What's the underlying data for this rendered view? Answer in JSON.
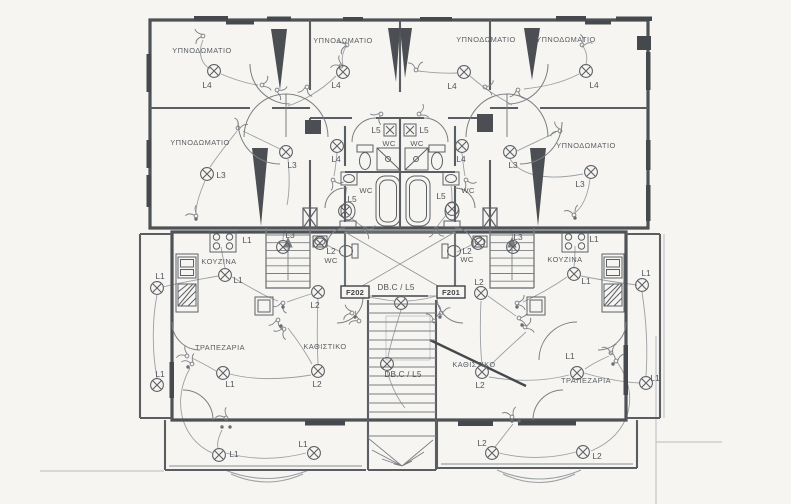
{
  "drawing": {
    "type": "electrical-floor-plan",
    "language": "Greek",
    "colors": {
      "paper": "#f6f5f1",
      "wall": "#4e5256",
      "ink": "#6a6e72",
      "wire": "#9aa0a4",
      "dark_fill": "#45494d",
      "text": "#5a5e63"
    },
    "rooms": [
      {
        "text": "ΥΠΝΟΔΩΜΑΤΙΟ",
        "x": 202,
        "y": 53
      },
      {
        "text": "ΥΠΝΟΔΩΜΑΤΙΟ",
        "x": 343,
        "y": 43
      },
      {
        "text": "ΥΠΝΟΔΩΜΑΤΙΟ",
        "x": 486,
        "y": 42
      },
      {
        "text": "ΥΠΝΟΔΩΜΑΤΙΟ",
        "x": 566,
        "y": 42
      },
      {
        "text": "ΥΠΝΟΔΩΜΑΤΙΟ",
        "x": 200,
        "y": 145
      },
      {
        "text": "ΥΠΝΟΔΩΜΑΤΙΟ",
        "x": 586,
        "y": 148
      },
      {
        "text": "ΚΟΥΖΙΝΑ",
        "x": 219,
        "y": 264
      },
      {
        "text": "ΚΟΥΖΙΝΑ",
        "x": 565,
        "y": 262
      },
      {
        "text": "ΤΡΑΠΕΖΑΡΙΑ",
        "x": 220,
        "y": 350
      },
      {
        "text": "ΤΡΑΠΕΖΑΡΙΑ",
        "x": 586,
        "y": 383
      },
      {
        "text": "ΚΑΘΙΣΤΙΚΟ",
        "x": 325,
        "y": 349
      },
      {
        "text": "ΚΑΘΙΣΤΙΚΟ",
        "x": 474,
        "y": 367
      }
    ],
    "wc_labels": [
      {
        "text": "WC",
        "x": 389,
        "y": 146
      },
      {
        "text": "WC",
        "x": 417,
        "y": 146
      },
      {
        "text": "WC",
        "x": 366,
        "y": 193
      },
      {
        "text": "WC",
        "x": 468,
        "y": 193
      },
      {
        "text": "WC",
        "x": 331,
        "y": 263
      },
      {
        "text": "WC",
        "x": 467,
        "y": 262
      }
    ],
    "panels": [
      {
        "text": "F202",
        "x": 355,
        "y": 295,
        "bx": 341,
        "by": 286,
        "w": 28,
        "h": 12
      },
      {
        "text": "F201",
        "x": 451,
        "y": 295,
        "bx": 437,
        "by": 286,
        "w": 28,
        "h": 12
      }
    ],
    "db_labels": [
      {
        "text": "DB.C / L5",
        "x": 396,
        "y": 290
      },
      {
        "text": "DB.C / L5",
        "x": 403,
        "y": 377
      }
    ],
    "lamps": [
      {
        "x": 214,
        "y": 71,
        "label": "L4",
        "lx": 207,
        "ly": 88
      },
      {
        "x": 343,
        "y": 72,
        "label": "L4",
        "lx": 336,
        "ly": 88
      },
      {
        "x": 464,
        "y": 72,
        "label": "L4",
        "lx": 452,
        "ly": 89
      },
      {
        "x": 586,
        "y": 71,
        "label": "L4",
        "lx": 594,
        "ly": 88
      },
      {
        "x": 207,
        "y": 174,
        "label": "L3",
        "lx": 221,
        "ly": 178
      },
      {
        "x": 286,
        "y": 152,
        "label": "L3",
        "lx": 292,
        "ly": 168
      },
      {
        "x": 510,
        "y": 152,
        "label": "L3",
        "lx": 513,
        "ly": 168
      },
      {
        "x": 591,
        "y": 172,
        "label": "L3",
        "lx": 580,
        "ly": 187
      },
      {
        "x": 337,
        "y": 146,
        "label": "L4",
        "lx": 336,
        "ly": 162
      },
      {
        "x": 462,
        "y": 146,
        "label": "L4",
        "lx": 461,
        "ly": 162
      },
      {
        "x": 345,
        "y": 211,
        "label": "L5",
        "lx": 352,
        "ly": 202
      },
      {
        "x": 452,
        "y": 209,
        "label": "L5",
        "lx": 441,
        "ly": 199
      },
      {
        "x": 320,
        "y": 243,
        "label": "L2",
        "lx": 331,
        "ly": 254
      },
      {
        "x": 478,
        "y": 243,
        "label": "L2",
        "lx": 467,
        "ly": 254
      },
      {
        "x": 283,
        "y": 247,
        "label": "L3",
        "lx": 290,
        "ly": 238
      },
      {
        "x": 513,
        "y": 247,
        "label": "L3",
        "lx": 518,
        "ly": 240
      },
      {
        "x": 401,
        "y": 303,
        "label": "",
        "lx": 0,
        "ly": 0
      },
      {
        "x": 387,
        "y": 364,
        "label": "",
        "lx": 0,
        "ly": 0
      },
      {
        "x": 225,
        "y": 275,
        "label": "L1",
        "lx": 238,
        "ly": 283
      },
      {
        "x": 574,
        "y": 274,
        "label": "L1",
        "lx": 586,
        "ly": 284
      },
      {
        "x": 157,
        "y": 288,
        "label": "L1",
        "lx": 160,
        "ly": 279
      },
      {
        "x": 157,
        "y": 385,
        "label": "L1",
        "lx": 160,
        "ly": 377
      },
      {
        "x": 642,
        "y": 285,
        "label": "L1",
        "lx": 646,
        "ly": 276
      },
      {
        "x": 646,
        "y": 383,
        "label": "L1",
        "lx": 655,
        "ly": 381
      },
      {
        "x": 223,
        "y": 373,
        "label": "L1",
        "lx": 230,
        "ly": 387
      },
      {
        "x": 318,
        "y": 292,
        "label": "L2",
        "lx": 315,
        "ly": 308
      },
      {
        "x": 318,
        "y": 371,
        "label": "L2",
        "lx": 317,
        "ly": 387
      },
      {
        "x": 481,
        "y": 293,
        "label": "L2",
        "lx": 479,
        "ly": 285
      },
      {
        "x": 482,
        "y": 372,
        "label": "L2",
        "lx": 480,
        "ly": 388
      },
      {
        "x": 577,
        "y": 373,
        "label": "L1",
        "lx": 570,
        "ly": 359
      },
      {
        "x": 219,
        "y": 455,
        "label": "L1",
        "lx": 234,
        "ly": 457
      },
      {
        "x": 314,
        "y": 453,
        "label": "L1",
        "lx": 303,
        "ly": 447
      },
      {
        "x": 492,
        "y": 453,
        "label": "L2",
        "lx": 482,
        "ly": 446
      },
      {
        "x": 583,
        "y": 452,
        "label": "L2",
        "lx": 597,
        "ly": 459
      }
    ],
    "sconces": [
      {
        "x": 390,
        "y": 130,
        "label": "L5",
        "lx": 376,
        "ly": 133
      },
      {
        "x": 410,
        "y": 130,
        "label": "L5",
        "lx": 424,
        "ly": 133
      }
    ],
    "extra_labels": [
      {
        "text": "L1",
        "x": 247,
        "y": 243
      },
      {
        "text": "L1",
        "x": 594,
        "y": 242
      }
    ],
    "switches": [
      {
        "x": 203,
        "y": 36,
        "r": 210
      },
      {
        "x": 262,
        "y": 85,
        "r": 20
      },
      {
        "x": 277,
        "y": 90,
        "r": 60
      },
      {
        "x": 307,
        "y": 87,
        "r": 140
      },
      {
        "x": 341,
        "y": 66,
        "r": 250
      },
      {
        "x": 347,
        "y": 45,
        "r": 200
      },
      {
        "x": 416,
        "y": 70,
        "r": 300
      },
      {
        "x": 582,
        "y": 45,
        "r": 340
      },
      {
        "x": 485,
        "y": 87,
        "r": 40
      },
      {
        "x": 518,
        "y": 90,
        "r": 130
      },
      {
        "x": 238,
        "y": 128,
        "r": 330
      },
      {
        "x": 560,
        "y": 131,
        "r": 230
      },
      {
        "x": 381,
        "y": 114,
        "r": 170
      },
      {
        "x": 419,
        "y": 114,
        "r": 10
      },
      {
        "x": 333,
        "y": 180,
        "r": 90
      },
      {
        "x": 466,
        "y": 180,
        "r": 90
      },
      {
        "x": 365,
        "y": 229,
        "r": 60
      },
      {
        "x": 436,
        "y": 229,
        "r": 120
      },
      {
        "x": 196,
        "y": 216,
        "r": 260
      },
      {
        "x": 574,
        "y": 215,
        "r": 280
      },
      {
        "x": 352,
        "y": 313,
        "r": 220
      },
      {
        "x": 359,
        "y": 321,
        "r": 240
      },
      {
        "x": 441,
        "y": 313,
        "r": 320
      },
      {
        "x": 434,
        "y": 321,
        "r": 300
      },
      {
        "x": 283,
        "y": 303,
        "r": 150
      },
      {
        "x": 517,
        "y": 303,
        "r": 30
      },
      {
        "x": 278,
        "y": 320,
        "r": 140
      },
      {
        "x": 284,
        "y": 329,
        "r": 160
      },
      {
        "x": 519,
        "y": 318,
        "r": 40
      },
      {
        "x": 525,
        "y": 327,
        "r": 20
      },
      {
        "x": 187,
        "y": 356,
        "r": 250
      },
      {
        "x": 192,
        "y": 364,
        "r": 270
      },
      {
        "x": 611,
        "y": 353,
        "r": 290
      },
      {
        "x": 616,
        "y": 361,
        "r": 310
      },
      {
        "x": 226,
        "y": 418,
        "r": 260
      },
      {
        "x": 512,
        "y": 417,
        "r": 280
      }
    ],
    "junction_dots": [
      {
        "x": 283,
        "y": 307
      },
      {
        "x": 517,
        "y": 307
      },
      {
        "x": 222,
        "y": 427
      },
      {
        "x": 230,
        "y": 427
      },
      {
        "x": 512,
        "y": 421
      },
      {
        "x": 519,
        "y": 421
      },
      {
        "x": 188,
        "y": 367
      },
      {
        "x": 613,
        "y": 364
      },
      {
        "x": 355,
        "y": 317
      },
      {
        "x": 440,
        "y": 317
      },
      {
        "x": 281,
        "y": 326
      },
      {
        "x": 522,
        "y": 325
      },
      {
        "x": 196,
        "y": 219
      },
      {
        "x": 575,
        "y": 218
      }
    ]
  }
}
